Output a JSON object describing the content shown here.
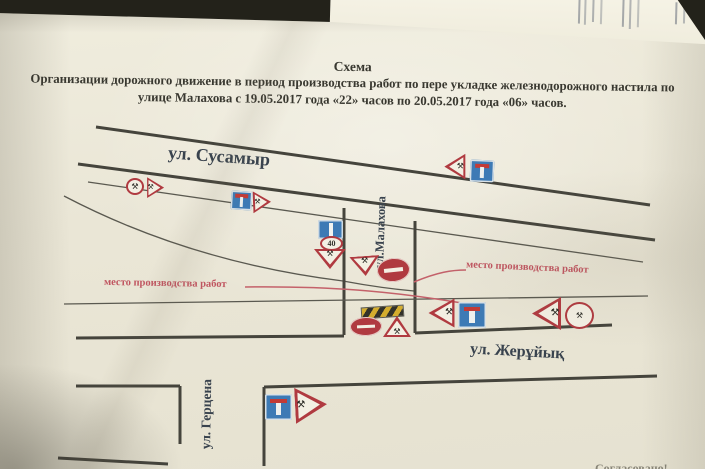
{
  "document": {
    "title_heading": "Схема",
    "title_line2": "Организации дорожного движение в период производства работ по пере укладке железнодорожного настила по",
    "title_line3": "улице Малахова с 19.05.2017 года «22» часов по 20.05.2017 года «06» часов."
  },
  "streets": {
    "susamyr_label": "ул. Сусамыр",
    "malakhova_label": "ул.Малахова",
    "zheruyk_label": "ул. Жерұйық",
    "gertsena_label": "ул. Герцена"
  },
  "annotations": {
    "work_zone_left_label": "место производства работ",
    "work_zone_right_label": "место производства работ",
    "approval_cut_label": "Согласовано!"
  },
  "signs": {
    "speed_limit_value": "40",
    "roadworks_glyph": "⚒"
  },
  "colors": {
    "desk": "#23221a",
    "paper": "#eae6d6",
    "ink": "#393830",
    "street_ink": "#39434e",
    "red_annotation": "#c05560",
    "sign_red": "#b03a40",
    "sign_blue": "#3d7ab5",
    "barrier_yellow": "#d4ad2e"
  }
}
